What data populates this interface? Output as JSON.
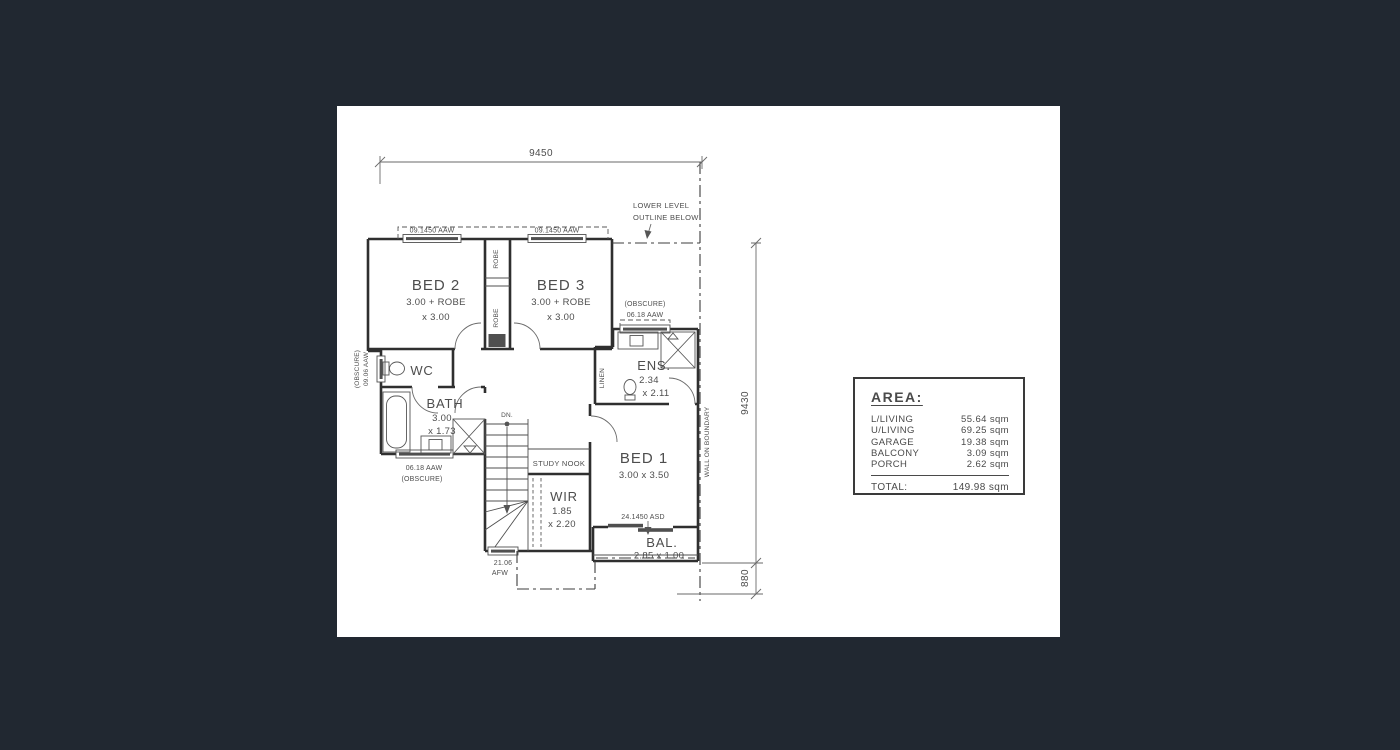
{
  "plan": {
    "dims": {
      "width": "9450",
      "height": "9430",
      "porch": "880"
    },
    "boundary_label": "WALL ON BOUNDARY",
    "lower_level": {
      "line1": "LOWER LEVEL",
      "line2": "OUTLINE BELOW"
    },
    "windows": {
      "top_left": "09.1450 AAW",
      "top_right": "09.1450 AAW",
      "ens_obscure": "(OBSCURE)",
      "ens": "06.18 AAW",
      "wc_obscure": "(OBSCURE)",
      "wc": "09.06 AAW",
      "bath": "06.18 AAW",
      "bath_obscure": "(OBSCURE)",
      "stair_size": "21.06",
      "stair_type": "AFW",
      "balcony_door": "24.1450 ASD"
    },
    "rooms": {
      "bed2": {
        "name": "BED 2",
        "d1": "3.00 + ROBE",
        "d2": "x 3.00"
      },
      "bed3": {
        "name": "BED 3",
        "d1": "3.00 + ROBE",
        "d2": "x 3.00"
      },
      "robe_a": "ROBE",
      "robe_b": "ROBE",
      "wc": "WC",
      "bath": {
        "name": "BATH",
        "d1": "3.00",
        "d2": "x 1.73"
      },
      "ens": {
        "name": "ENS.",
        "d1": "2.34",
        "d2": "x 2.11"
      },
      "linen": "LINEN",
      "stairs_dn": "DN.",
      "study": "STUDY NOOK",
      "bed1": {
        "name": "BED 1",
        "d1": "3.00 x 3.50"
      },
      "wir": {
        "name": "WIR",
        "d1": "1.85",
        "d2": "x 2.20"
      },
      "bal": {
        "name": "BAL.",
        "d1": "2.85 x 1.00"
      }
    }
  },
  "area_table": {
    "title": "AREA:",
    "rows": [
      {
        "label": "L/LIVING",
        "value": "55.64 sqm"
      },
      {
        "label": "U/LIVING",
        "value": "69.25 sqm"
      },
      {
        "label": "GARAGE",
        "value": "19.38 sqm"
      },
      {
        "label": "BALCONY",
        "value": "3.09 sqm"
      },
      {
        "label": "PORCH",
        "value": "2.62 sqm"
      }
    ],
    "total_label": "TOTAL:",
    "total_value": "149.98 sqm"
  }
}
